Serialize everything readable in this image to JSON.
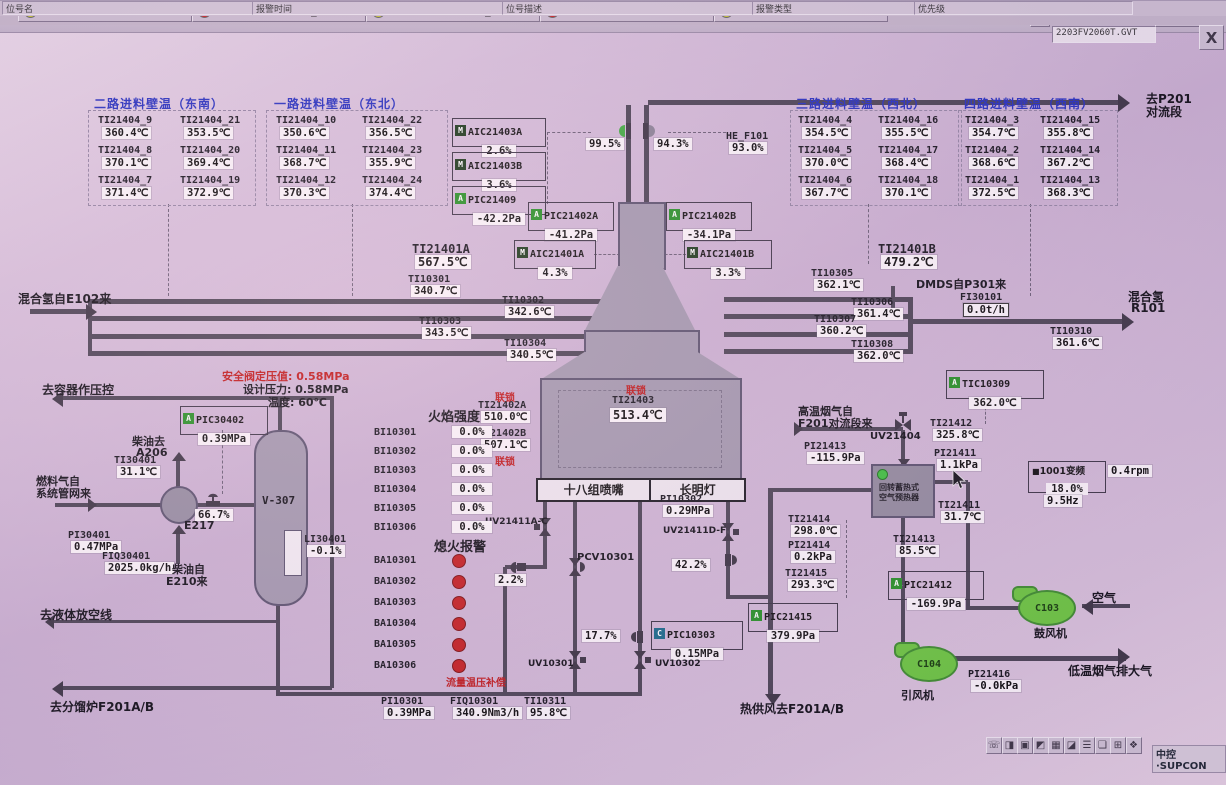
{
  "window": {
    "filename": "2203FV2060T.GVT",
    "panel_button": "仪表面板",
    "dropdown_glyph": "▾",
    "close_glyph": "X",
    "faceplate_icon": "▤"
  },
  "statusbar": {
    "left": "就绪",
    "right": "[域: DA0[操作域]_加氢裂化联合装置]  操作小组: 加氢裂化操作组  用户: 值班员  画面: 06_F101控制图  流程图 8/54  2022-04-23 10:28:36"
  },
  "title": "氢气加热炉F101控制图",
  "toolbar_icons": [
    {
      "x": 44,
      "g": "⌂",
      "n": "home-icon"
    },
    {
      "x": 65,
      "g": "▦",
      "n": "overview-icon"
    },
    {
      "x": 86,
      "g": "▣",
      "n": "window-icon"
    },
    {
      "x": 107,
      "g": "▨",
      "n": "trend-icon",
      "c": "#9a6d12"
    },
    {
      "x": 128,
      "g": "▩",
      "n": "group-display-icon"
    },
    {
      "x": 149,
      "g": "▥",
      "n": "faceplate-list-icon"
    },
    {
      "x": 170,
      "g": "▤",
      "n": "report-icon"
    },
    {
      "x": 200,
      "g": "◀",
      "n": "back-icon",
      "c": "#2a8a2a",
      "w": 20
    },
    {
      "x": 221,
      "g": "▾",
      "n": "back-dropdown-icon",
      "w": 10
    },
    {
      "x": 233,
      "g": "▶",
      "n": "forward-icon",
      "c": "#2a8a2a",
      "w": 20
    },
    {
      "x": 254,
      "g": "▾",
      "n": "forward-dropdown-icon",
      "w": 10
    },
    {
      "x": 268,
      "g": "❐",
      "n": "page-previous-icon"
    },
    {
      "x": 289,
      "g": "❏",
      "n": "page-next-icon"
    },
    {
      "x": 310,
      "g": "▤",
      "n": "book-icon"
    },
    {
      "x": 338,
      "g": "⊙",
      "n": "search-icon",
      "c": "#9a6d12"
    },
    {
      "x": 362,
      "g": "☺",
      "n": "user-icon"
    },
    {
      "x": 383,
      "g": "▾",
      "n": "user-dropdown-icon",
      "w": 10
    }
  ],
  "tables": [
    {
      "title": "二路进料壁温（东南）",
      "tx": 94,
      "ty": 95,
      "x": 88,
      "y": 110,
      "w": 166,
      "h": 94,
      "cols": [
        10,
        92
      ],
      "cells": [
        [
          {
            "tag": "TI21404_9",
            "val": "360.4℃"
          },
          {
            "tag": "TI21404_21",
            "val": "353.5℃"
          }
        ],
        [
          {
            "tag": "TI21404_8",
            "val": "370.1℃"
          },
          {
            "tag": "TI21404_20",
            "val": "369.4℃"
          }
        ],
        [
          {
            "tag": "TI21404_7",
            "val": "371.4℃"
          },
          {
            "tag": "TI21404_19",
            "val": "372.9℃"
          }
        ]
      ]
    },
    {
      "title": "一路进料壁温（东北）",
      "tx": 274,
      "ty": 95,
      "x": 266,
      "y": 110,
      "w": 180,
      "h": 94,
      "cols": [
        10,
        96
      ],
      "cells": [
        [
          {
            "tag": "TI21404_10",
            "val": "350.6℃"
          },
          {
            "tag": "TI21404_22",
            "val": "356.5℃"
          }
        ],
        [
          {
            "tag": "TI21404_11",
            "val": "368.7℃"
          },
          {
            "tag": "TI21404_23",
            "val": "355.9℃"
          }
        ],
        [
          {
            "tag": "TI21404_12",
            "val": "370.3℃"
          },
          {
            "tag": "TI21404_24",
            "val": "374.4℃"
          }
        ]
      ]
    },
    {
      "title": "三路进料壁温（西北）",
      "tx": 796,
      "ty": 95,
      "x": 790,
      "y": 110,
      "w": 170,
      "h": 94,
      "cols": [
        8,
        88
      ],
      "cells": [
        [
          {
            "tag": "TI21404_4",
            "val": "354.5℃"
          },
          {
            "tag": "TI21404_16",
            "val": "355.5℃"
          }
        ],
        [
          {
            "tag": "TI21404_5",
            "val": "370.0℃"
          },
          {
            "tag": "TI21404_17",
            "val": "368.4℃"
          }
        ],
        [
          {
            "tag": "TI21404_6",
            "val": "367.7℃"
          },
          {
            "tag": "TI21404_18",
            "val": "370.1℃"
          }
        ]
      ]
    },
    {
      "title": "四路进料壁温（西南）",
      "tx": 964,
      "ty": 95,
      "x": 958,
      "y": 110,
      "w": 158,
      "h": 94,
      "cols": [
        7,
        82
      ],
      "cells": [
        [
          {
            "tag": "TI21404_3",
            "val": "354.7℃"
          },
          {
            "tag": "TI21404_15",
            "val": "355.8℃"
          }
        ],
        [
          {
            "tag": "TI21404_2",
            "val": "368.6℃"
          },
          {
            "tag": "TI21404_14",
            "val": "367.2℃"
          }
        ],
        [
          {
            "tag": "TI21404_1",
            "val": "372.5℃"
          },
          {
            "tag": "TI21404_13",
            "val": "368.3℃"
          }
        ]
      ]
    }
  ],
  "boxed_instruments": [
    {
      "x": 452,
      "y": 118,
      "chip": "M",
      "tag": "AIC21403A",
      "val": "2.6%",
      "w": 92
    },
    {
      "x": 452,
      "y": 152,
      "chip": "M",
      "tag": "AIC21403B",
      "val": "3.6%",
      "w": 92
    },
    {
      "x": 452,
      "y": 186,
      "chip": "A",
      "tag": "PIC21409",
      "val": "-42.2Pa",
      "w": 92
    },
    {
      "x": 528,
      "y": 202,
      "chip": "A",
      "tag": "PIC21402A",
      "val": "-41.2Pa",
      "w": 84
    },
    {
      "x": 666,
      "y": 202,
      "chip": "A",
      "tag": "PIC21402B",
      "val": "-34.1Pa",
      "w": 84
    },
    {
      "x": 514,
      "y": 240,
      "chip": "M",
      "tag": "AIC21401A",
      "val": "4.3%",
      "w": 80
    },
    {
      "x": 684,
      "y": 240,
      "chip": "M",
      "tag": "AIC21401B",
      "val": "3.3%",
      "w": 86
    },
    {
      "x": 946,
      "y": 370,
      "chip": "A",
      "tag": "TIC10309",
      "val": "362.0℃",
      "w": 96
    },
    {
      "x": 651,
      "y": 621,
      "chip": "C",
      "tag": "PIC10303",
      "val": "0.15MPa",
      "w": 90
    },
    {
      "x": 748,
      "y": 603,
      "chip": "A",
      "tag": "PIC21415",
      "val": "379.9Pa",
      "w": 88
    },
    {
      "x": 888,
      "y": 571,
      "chip": "A",
      "tag": "PIC21412",
      "val": "-169.9Pa",
      "w": 94
    },
    {
      "x": 180,
      "y": 406,
      "chip": "A",
      "tag": "PIC30402",
      "val": "0.39MPa",
      "w": 86
    }
  ],
  "instruments": [
    {
      "x": 412,
      "y": 242,
      "tag": "TI21401A",
      "val": "567.5℃",
      "big": 1
    },
    {
      "x": 408,
      "y": 274,
      "tag": "TI10301",
      "val": "340.7℃"
    },
    {
      "x": 502,
      "y": 295,
      "tag": "TI10302",
      "val": "342.6℃"
    },
    {
      "x": 419,
      "y": 316,
      "tag": "TI10303",
      "val": "343.5℃"
    },
    {
      "x": 504,
      "y": 338,
      "tag": "TI10304",
      "val": "340.5℃"
    },
    {
      "x": 878,
      "y": 242,
      "tag": "TI21401B",
      "val": "479.2℃",
      "big": 1
    },
    {
      "x": 811,
      "y": 268,
      "tag": "TI10305",
      "val": "362.1℃"
    },
    {
      "x": 851,
      "y": 297,
      "tag": "TI10306",
      "val": "361.4℃"
    },
    {
      "x": 814,
      "y": 314,
      "tag": "TI10307",
      "val": "360.2℃"
    },
    {
      "x": 851,
      "y": 339,
      "tag": "TI10308",
      "val": "362.0℃"
    },
    {
      "x": 960,
      "y": 292,
      "tag": "FI30101",
      "val": "0.0t/h",
      "vb": 1
    },
    {
      "x": 1050,
      "y": 326,
      "tag": "TI10310",
      "val": "361.6℃"
    },
    {
      "x": 478,
      "y": 400,
      "tag": "TI21402A",
      "val": "510.0℃"
    },
    {
      "x": 478,
      "y": 428,
      "tag": "TI21402B",
      "val": "507.1℃"
    },
    {
      "x": 660,
      "y": 494,
      "tag": "PI10302",
      "val": "0.29MPa"
    },
    {
      "x": 930,
      "y": 418,
      "tag": "TI21412",
      "val": "325.8℃"
    },
    {
      "x": 804,
      "y": 441,
      "tag": "PI21413",
      "val": "-115.9Pa"
    },
    {
      "x": 934,
      "y": 448,
      "tag": "PI21411",
      "val": "1.1kPa"
    },
    {
      "x": 938,
      "y": 500,
      "tag": "TI21411",
      "val": "31.7℃"
    },
    {
      "x": 788,
      "y": 514,
      "tag": "TI21414",
      "val": "298.0℃"
    },
    {
      "x": 788,
      "y": 540,
      "tag": "PI21414",
      "val": "0.2kPa"
    },
    {
      "x": 893,
      "y": 534,
      "tag": "TI21413",
      "val": "85.5℃"
    },
    {
      "x": 785,
      "y": 568,
      "tag": "TI21415",
      "val": "293.3℃"
    },
    {
      "x": 968,
      "y": 669,
      "tag": "PI21416",
      "val": "-0.0kPa"
    },
    {
      "x": 381,
      "y": 696,
      "tag": "PI10301",
      "val": "0.39MPa"
    },
    {
      "x": 450,
      "y": 696,
      "tag": "FIQ10301",
      "val": "340.9Nm3/h"
    },
    {
      "x": 524,
      "y": 696,
      "tag": "TI10311",
      "val": "95.8℃"
    },
    {
      "x": 114,
      "y": 455,
      "tag": "TI30401",
      "val": "31.1℃"
    },
    {
      "x": 68,
      "y": 530,
      "tag": "PI30401",
      "val": "0.47MPa"
    },
    {
      "x": 102,
      "y": 551,
      "tag": "FIQ30401",
      "val": "2025.0kg/h"
    },
    {
      "x": 304,
      "y": 534,
      "tag": "LI30401",
      "val": "-0.1%"
    },
    {
      "x": 726,
      "y": 131,
      "tag": "HE_F101",
      "val": "93.0%"
    }
  ],
  "percents": [
    {
      "x": 586,
      "y": 138,
      "val": "99.5%",
      "n": "stack-damper-a-output"
    },
    {
      "x": 654,
      "y": 138,
      "val": "94.3%",
      "n": "stack-damper-b-output"
    },
    {
      "x": 195,
      "y": 509,
      "val": "66.7%",
      "n": "fuel-valve-output"
    },
    {
      "x": 495,
      "y": 574,
      "val": "2.2%",
      "n": "burner-valve-output"
    },
    {
      "x": 672,
      "y": 559,
      "val": "42.2%",
      "n": "pilot-valve-output"
    },
    {
      "x": 582,
      "y": 630,
      "val": "17.7%",
      "n": "pic10303-valve-output"
    }
  ],
  "labels": [
    {
      "x": 18,
      "y": 290,
      "t": "混合氢自E102来",
      "s": 12,
      "b": 1
    },
    {
      "x": 1146,
      "y": 90,
      "t": "去P201",
      "s": 12,
      "b": 1
    },
    {
      "x": 1146,
      "y": 103,
      "t": "对流段",
      "s": 12,
      "b": 1
    },
    {
      "x": 916,
      "y": 276,
      "t": "DMDS自P301来",
      "s": 11,
      "b": 1
    },
    {
      "x": 1128,
      "y": 288,
      "t": "混合氢",
      "s": 12,
      "b": 1
    },
    {
      "x": 1131,
      "y": 301,
      "t": "R101",
      "s": 12,
      "b": 1
    },
    {
      "x": 42,
      "y": 381,
      "t": "去容器作压控",
      "s": 12,
      "b": 1
    },
    {
      "x": 222,
      "y": 368,
      "t": "安全阀定压值: 0.58MPa",
      "s": 11,
      "b": 1,
      "c": "#c01818"
    },
    {
      "x": 243,
      "y": 381,
      "t": "设计压力: 0.58MPa",
      "s": 11,
      "b": 1
    },
    {
      "x": 268,
      "y": 394,
      "t": "温度: 60℃",
      "s": 11,
      "b": 1
    },
    {
      "x": 132,
      "y": 433,
      "t": "柴油去",
      "s": 11,
      "b": 1
    },
    {
      "x": 136,
      "y": 446,
      "t": "A206",
      "s": 11,
      "b": 1
    },
    {
      "x": 36,
      "y": 473,
      "t": "燃料气自",
      "s": 11,
      "b": 1
    },
    {
      "x": 36,
      "y": 485,
      "t": "系统管网来",
      "s": 11,
      "b": 1
    },
    {
      "x": 184,
      "y": 519,
      "t": "E217",
      "s": 11,
      "b": 1
    },
    {
      "x": 40,
      "y": 606,
      "t": "去液体放空线",
      "s": 12,
      "b": 1
    },
    {
      "x": 50,
      "y": 698,
      "t": "去分馏炉F201A/B",
      "s": 12,
      "b": 1
    },
    {
      "x": 172,
      "y": 561,
      "t": "柴油自",
      "s": 11,
      "b": 1
    },
    {
      "x": 166,
      "y": 573,
      "t": "E210来",
      "s": 11,
      "b": 1
    },
    {
      "x": 798,
      "y": 403,
      "t": "高温烟气自",
      "s": 11,
      "b": 1
    },
    {
      "x": 798,
      "y": 415,
      "t": "F201对流段来",
      "s": 11,
      "b": 1
    },
    {
      "x": 870,
      "y": 431,
      "t": "UV21404",
      "s": 10,
      "b": 1
    },
    {
      "x": 1092,
      "y": 589,
      "t": "空气",
      "s": 12,
      "b": 1
    },
    {
      "x": 1034,
      "y": 625,
      "t": "鼓风机",
      "s": 11,
      "b": 1
    },
    {
      "x": 901,
      "y": 687,
      "t": "引风机",
      "s": 11,
      "b": 1
    },
    {
      "x": 1068,
      "y": 662,
      "t": "低温烟气排大气",
      "s": 12,
      "b": 1
    },
    {
      "x": 740,
      "y": 700,
      "t": "热供风去F201A/B",
      "s": 12,
      "b": 1
    },
    {
      "x": 446,
      "y": 674,
      "t": "流量温压补偿",
      "s": 10,
      "b": 1,
      "c": "#c01818"
    },
    {
      "x": 485,
      "y": 517,
      "t": "UV21411A-C",
      "s": 9,
      "b": 1
    },
    {
      "x": 663,
      "y": 526,
      "t": "UV21411D-F",
      "s": 9,
      "b": 1
    },
    {
      "x": 577,
      "y": 552,
      "t": "PCV10301",
      "s": 10,
      "b": 1
    },
    {
      "x": 528,
      "y": 659,
      "t": "UV10301",
      "s": 9,
      "b": 1
    },
    {
      "x": 655,
      "y": 659,
      "t": "UV10302",
      "s": 9,
      "b": 1
    },
    {
      "x": 495,
      "y": 389,
      "t": "联锁",
      "s": 10,
      "b": 1,
      "c": "#c01818"
    },
    {
      "x": 495,
      "y": 453,
      "t": "联锁",
      "s": 10,
      "b": 1,
      "c": "#c01818"
    }
  ],
  "flame": {
    "title": "火焰强度",
    "rows": [
      {
        "tag": "BI10301",
        "val": "0.0%"
      },
      {
        "tag": "BI10302",
        "val": "0.0%"
      },
      {
        "tag": "BI10303",
        "val": "0.0%"
      },
      {
        "tag": "BI10304",
        "val": "0.0%"
      },
      {
        "tag": "BI10305",
        "val": "0.0%"
      },
      {
        "tag": "BI10306",
        "val": "0.0%"
      }
    ]
  },
  "flameout": {
    "title": "熄火报警",
    "tags": [
      "BA10301",
      "BA10302",
      "BA10303",
      "BA10304",
      "BA10305",
      "BA10306"
    ]
  },
  "furnace": {
    "interlock": "联锁",
    "tag": "TI21403",
    "val": "513.4℃",
    "burner_left": "十八组喷嘴",
    "burner_right": "长明灯"
  },
  "vfd": {
    "prefix": "■",
    "label": "1001变频",
    "percent": "18.0%",
    "hz": "9.5Hz",
    "rpm": "0.4rpm"
  },
  "equipment": {
    "vessel": "V-307",
    "exchanger": "E217",
    "blower": "C103",
    "fan": "C104",
    "preheater_line1": "回转蓄热式",
    "preheater_line2": "空气预热器"
  },
  "alarm_bar": {
    "cells": [
      {
        "color": "#c9c92e",
        "tag": "2203TI30301"
      },
      {
        "color": "#d42020",
        "tag": "2203PI62310_SIS"
      },
      {
        "color": "#c9c92e",
        "tag": "2203PI62310_SIS"
      },
      {
        "color": "#d42020",
        "tag": "2203TI60206"
      },
      {
        "color": "#c9c92e",
        "tag": "2203TI60206"
      }
    ],
    "icons": [
      {
        "g": "☏",
        "n": "phone-icon"
      },
      {
        "g": "◨",
        "n": "key-icon"
      },
      {
        "g": "▣",
        "n": "monitor-icon"
      },
      {
        "g": "◩",
        "n": "save-icon"
      },
      {
        "g": "▦",
        "n": "calendar-icon"
      },
      {
        "g": "◪",
        "n": "alarm-bell-icon"
      },
      {
        "g": "☰",
        "n": "alarm-list-icon"
      },
      {
        "g": "❏",
        "n": "log-icon"
      },
      {
        "g": "⊞",
        "n": "tiles-icon"
      },
      {
        "g": "❖",
        "n": "help-icon"
      }
    ],
    "fields": [
      "位号名",
      "报警时间",
      "位号描述",
      "报警类型",
      "优先级"
    ],
    "logo": "中控·SUPCON"
  },
  "colors": {
    "chipM": "#1a3a1a",
    "chipA": "#259325",
    "chipC": "#176b8a",
    "pipe": "#4a4454",
    "green": "#3fae3f",
    "gray": "#8a8496",
    "red_dot": "#c41f1f"
  }
}
